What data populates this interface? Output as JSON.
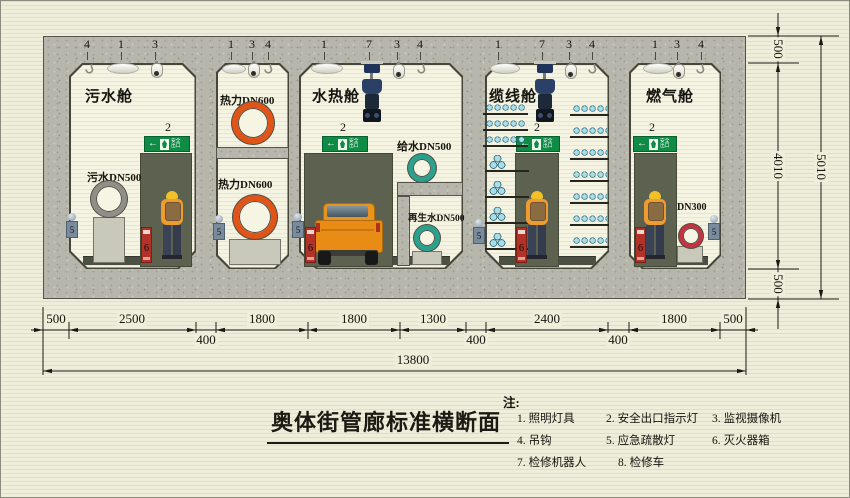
{
  "title": "奥体街管廊标准横断面",
  "notes": {
    "heading": "注:",
    "items": [
      {
        "num": "1.",
        "label": "照明灯具"
      },
      {
        "num": "2.",
        "label": "安全出口指示灯"
      },
      {
        "num": "3.",
        "label": "监视摄像机"
      },
      {
        "num": "4.",
        "label": "吊钩"
      },
      {
        "num": "5.",
        "label": "应急疏散灯"
      },
      {
        "num": "6.",
        "label": "灭火器箱"
      },
      {
        "num": "7.",
        "label": "检修机器人"
      },
      {
        "num": "8.",
        "label": "检修车"
      }
    ]
  },
  "compartments": {
    "sewage": {
      "name": "污水舱",
      "pipe": "污水DN500"
    },
    "heat": {
      "upper_label": "热力DN600",
      "lower_label": "热力DN600"
    },
    "water": {
      "name": "水热舱",
      "supply": "给水DN500",
      "reclaimed": "再生水DN500",
      "truck_num": "8"
    },
    "cable": {
      "name": "缆线舱"
    },
    "gas": {
      "name": "燃气舱",
      "pipe": "DN300"
    }
  },
  "callouts": {
    "sewage": [
      "4",
      "1",
      "3"
    ],
    "heat": [
      "1",
      "3",
      "4"
    ],
    "water": [
      "1",
      "7",
      "3",
      "4"
    ],
    "cable": [
      "1",
      "7",
      "3",
      "4"
    ],
    "gas": [
      "1",
      "3",
      "4"
    ]
  },
  "exit_sign": {
    "number": "2",
    "text": "安全出口"
  },
  "equipment": {
    "emergency_light_num": "5",
    "fire_box_num": "6"
  },
  "dimensions": {
    "bottom": [
      "500",
      "2500",
      "400",
      "1800",
      "1800",
      "1300",
      "400",
      "2400",
      "400",
      "1800",
      "500"
    ],
    "total_width": "13800",
    "right_top": "500",
    "right_middle": "4010",
    "right_bottom": "500",
    "total_height": "5010"
  },
  "colors": {
    "background": "#efeedb",
    "concrete": "#b6b6ac",
    "interior": "#f5f3e1",
    "recess": "#5d6150",
    "exit_green": "#0e8c45",
    "heat_pipe": "#e05418",
    "water_pipe": "#2aa18c",
    "sewage_pipe": "#8f8f88",
    "gas_pipe": "#c43341",
    "fire_box": "#b33227",
    "worker_suit": "#ef9b2f",
    "truck": "#e98c15",
    "cable": "#abdcea",
    "robot": "#2b4066"
  }
}
